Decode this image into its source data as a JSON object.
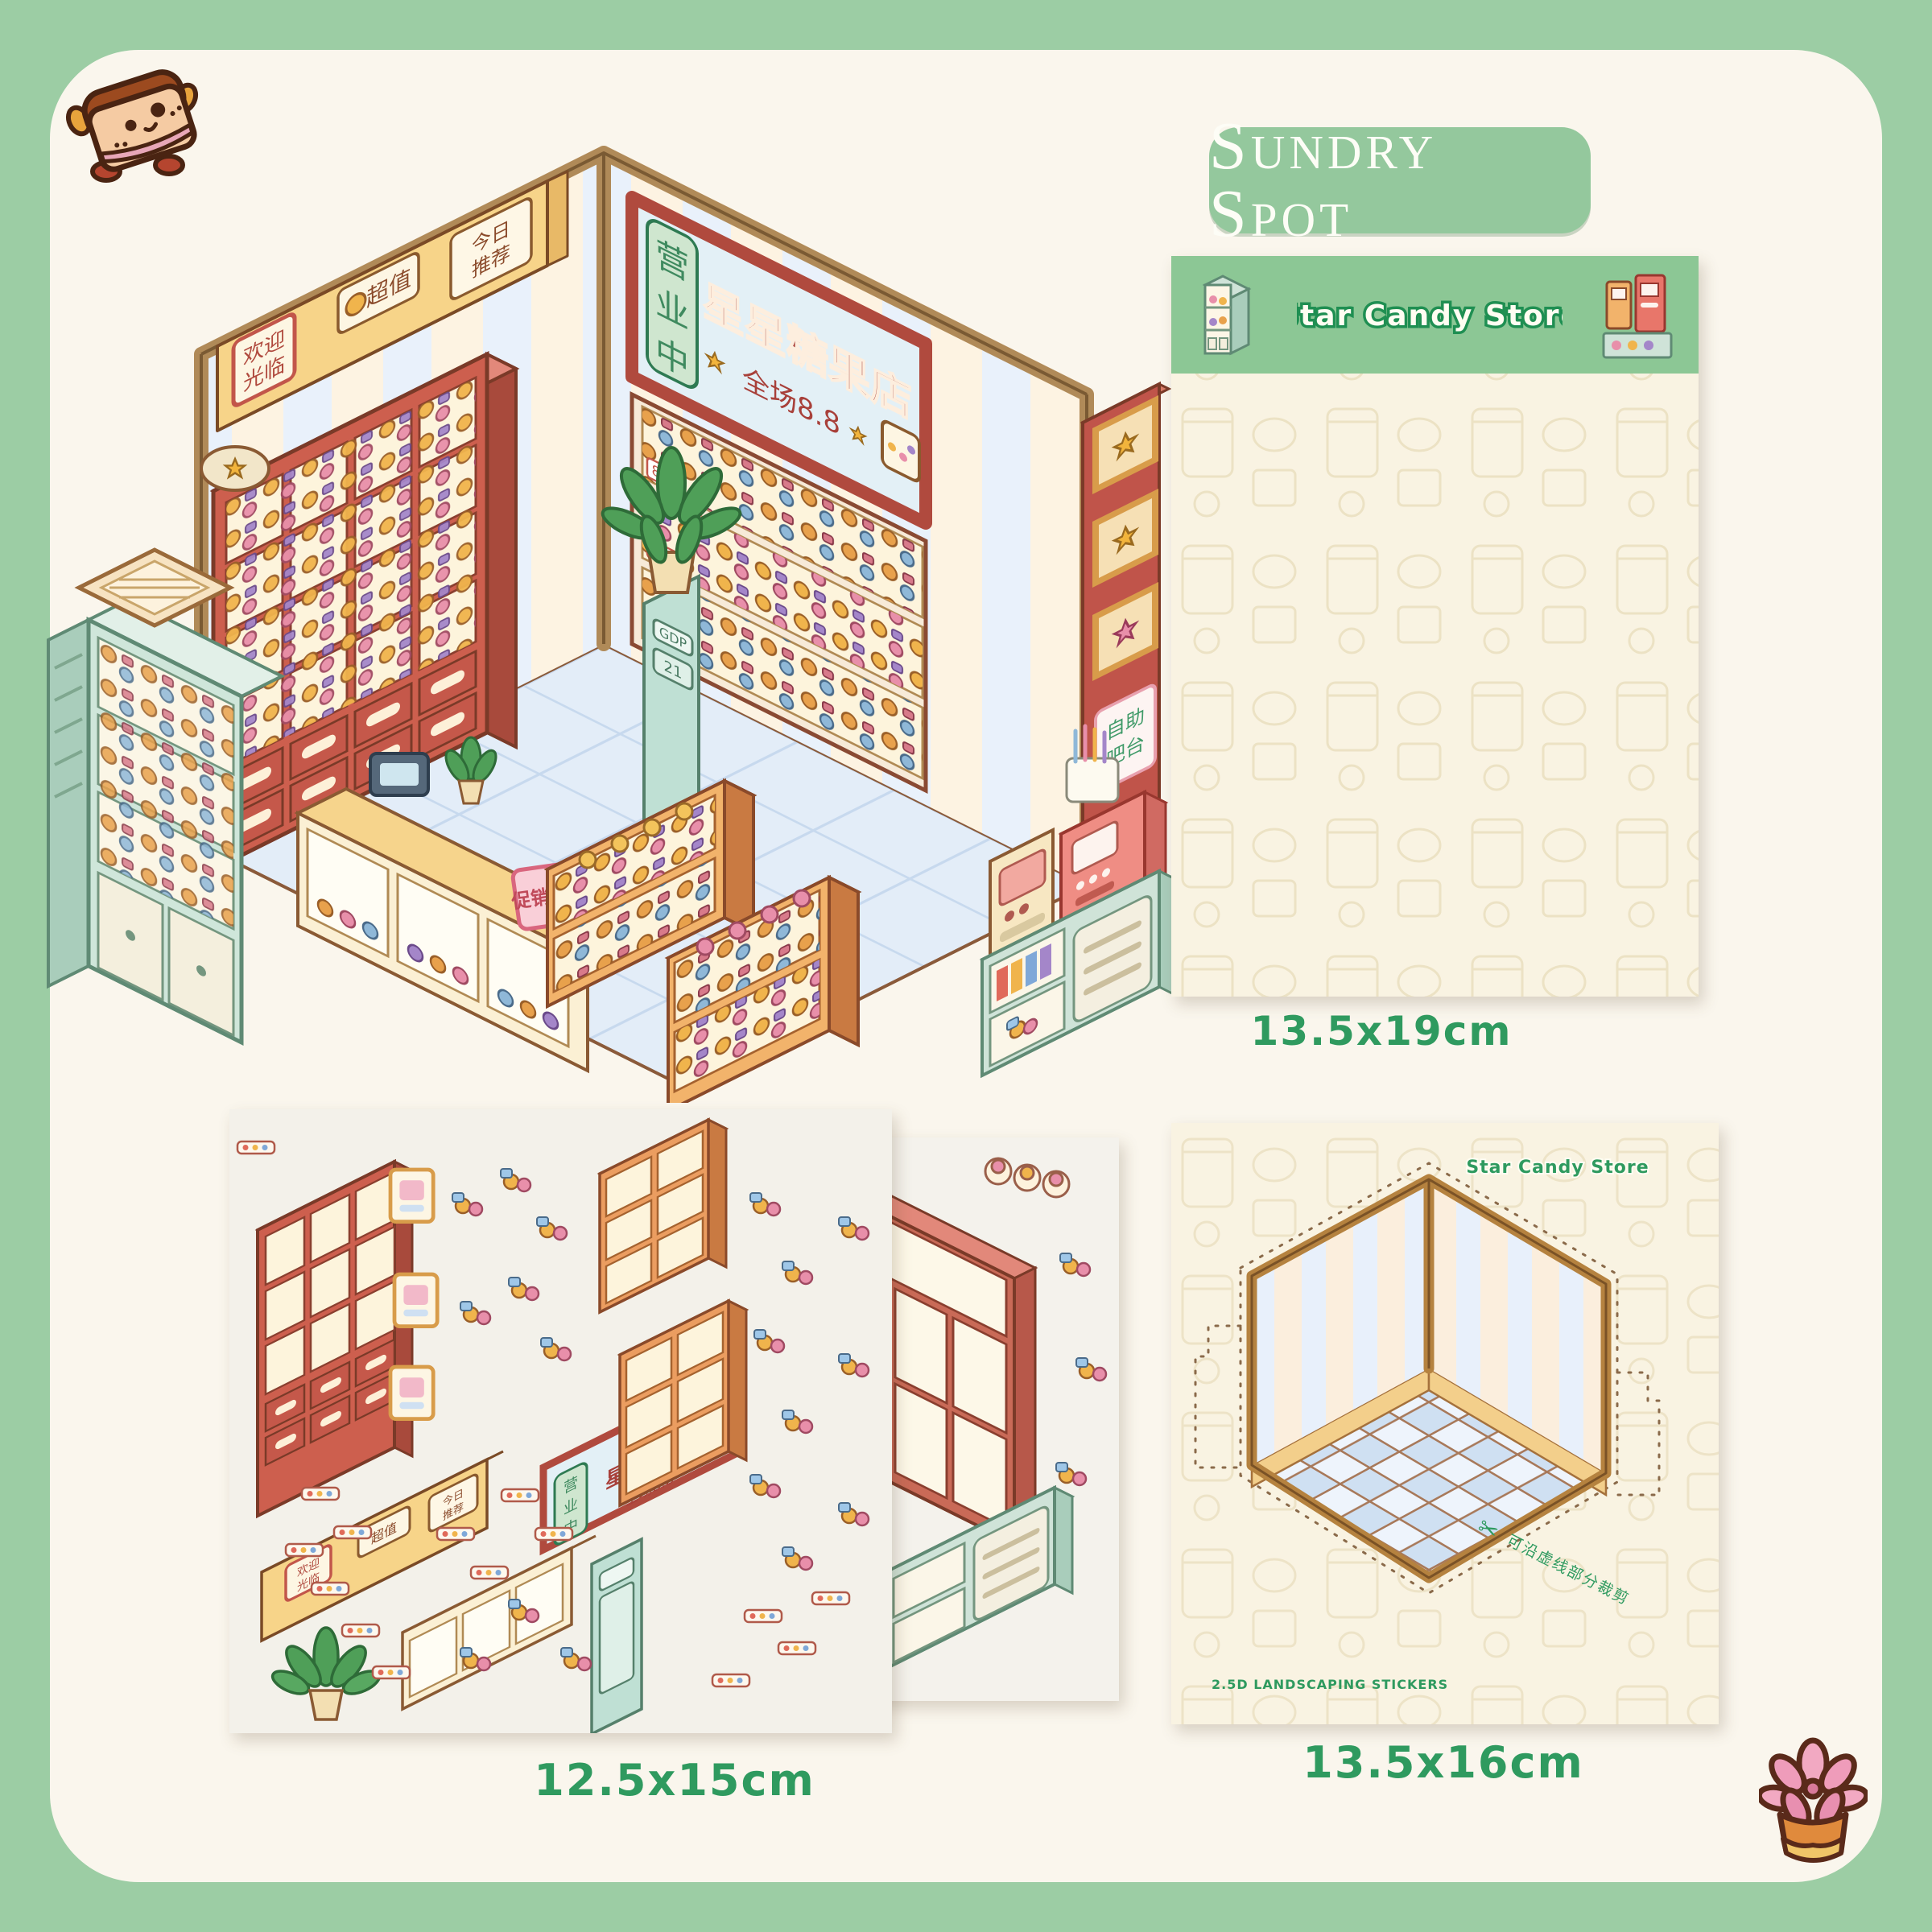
{
  "badge": {
    "title": "Sundry Spot"
  },
  "brand": "Star Candy Store",
  "store_sign": {
    "open_chars": [
      "营",
      "业",
      "中"
    ],
    "name": "星星糖果店",
    "promo": "全场8.8",
    "price_tag": "8.8",
    "counter_tag": "促销价¥6.6",
    "self_note_lines": [
      "自助",
      "吧台"
    ],
    "pillar_top": "GDP",
    "pillar_screen": "21"
  },
  "hanging_sign": {
    "welcome_lines": [
      "欢迎",
      "光临"
    ],
    "value_label": "超值",
    "daily_lines": [
      "今日",
      "推荐"
    ]
  },
  "sheets": {
    "pattern_sheet": {
      "header_title": "Star Candy Store",
      "size": "13.5x19cm"
    },
    "elements_sheet": {
      "size": "12.5x15cm"
    },
    "background_sheet": {
      "brand": "Star Candy Store",
      "scissors": "✂",
      "cut_note": "可沿虚线部分裁剪",
      "type_label": "2.5D LANDSCAPING STICKERS",
      "size": "13.5x16cm"
    }
  },
  "icons": {
    "top_left_mascot": "toast-cake-character",
    "bottom_right_decor": "pink-succulent-pot",
    "header_left": "shelf-illustration",
    "header_right": "vending-machines-illustration"
  },
  "colors": {
    "frame_green": "#9ccda4",
    "panel_cream": "#faf6ed",
    "header_green": "#8cc795",
    "pill_green": "#94c89d",
    "text_green": "#2f9a5f",
    "sheet_cream": "#f9f3e2",
    "sheet_white": "#f3f1ea",
    "terracotta": "#c96a57",
    "wood_tan": "#f3cd86",
    "mint": "#cfe3d8",
    "floor_blue": "#dfeaf6",
    "candy_gold": "#f0b44c",
    "candy_pink": "#e88faa"
  }
}
